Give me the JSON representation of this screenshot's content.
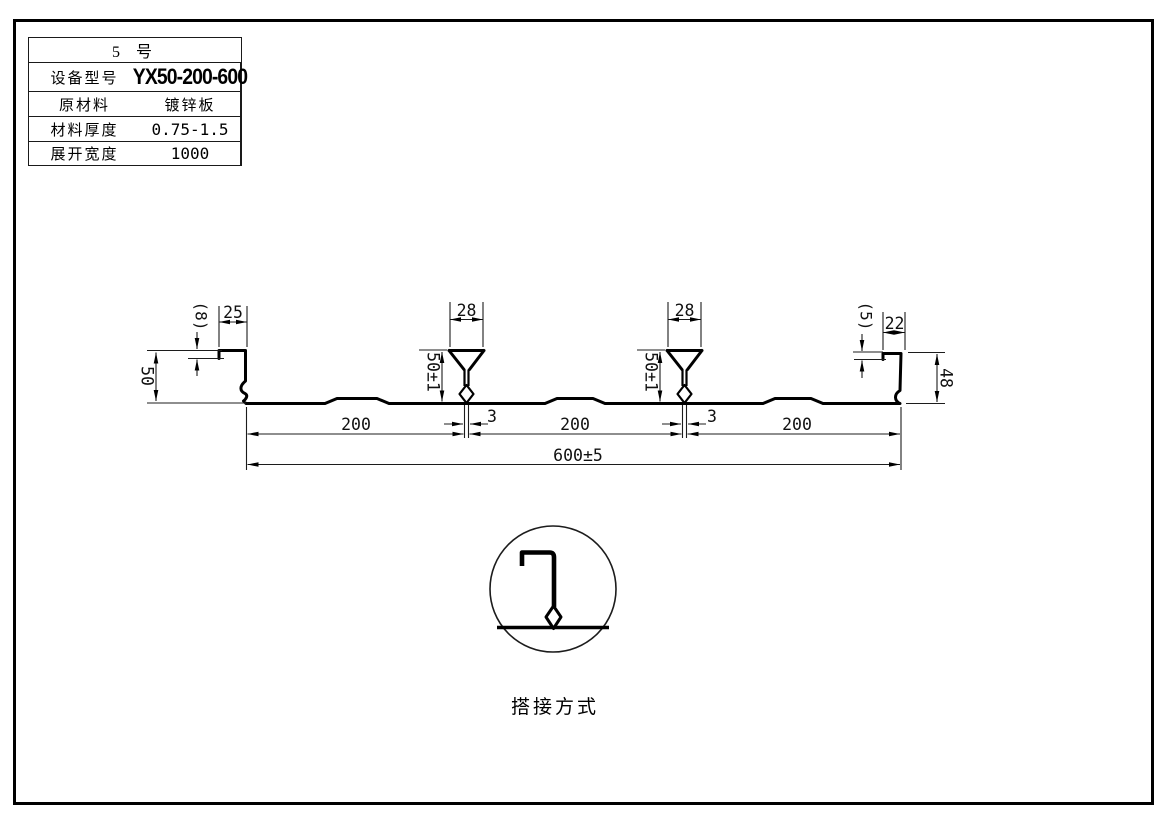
{
  "spec_table": {
    "title": "5 号",
    "rows": [
      {
        "label": "设备型号",
        "value": "YX50-200-600"
      },
      {
        "label": "原材料",
        "value": "镀锌板"
      },
      {
        "label": "材料厚度",
        "value": "0.75-1.5"
      },
      {
        "label": "展开宽度",
        "value": "1000"
      }
    ]
  },
  "drawing": {
    "dims": {
      "left_lip": "(8)",
      "left_top": "25",
      "left_height": "50",
      "rib1_width": "28",
      "rib1_height": "50±1",
      "rib1_gap": "3",
      "rib2_width": "28",
      "rib2_height": "50±1",
      "rib2_gap": "3",
      "right_lip": "(5)",
      "right_top": "22",
      "right_height": "48",
      "pitch1": "200",
      "pitch2": "200",
      "pitch3": "200",
      "overall": "600±5"
    },
    "detail_label": "搭接方式"
  }
}
